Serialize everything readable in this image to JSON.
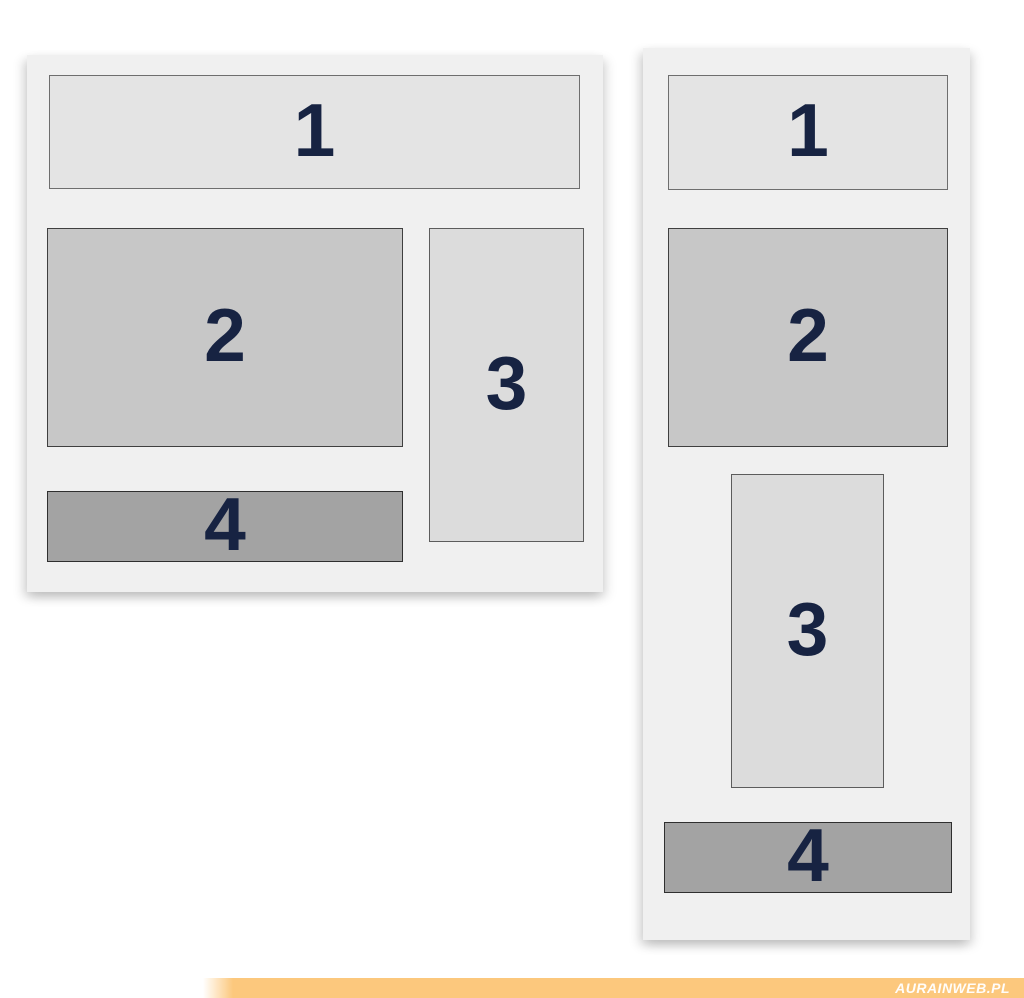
{
  "diagram": {
    "desktop": {
      "blocks": [
        {
          "label": "1"
        },
        {
          "label": "2"
        },
        {
          "label": "3"
        },
        {
          "label": "4"
        }
      ]
    },
    "mobile": {
      "blocks": [
        {
          "label": "1"
        },
        {
          "label": "2"
        },
        {
          "label": "3"
        },
        {
          "label": "4"
        }
      ]
    }
  },
  "watermark": {
    "text": "AURAINWEB.PL"
  },
  "colors": {
    "page_background": "#ffffff",
    "panel_background": "#f0f0f0",
    "block1_fill": "#e4e4e4",
    "block2_fill": "#c7c7c7",
    "block3_fill": "#dcdcdc",
    "block4_fill": "#a3a3a3",
    "block_border_light": "#6e6e6e",
    "block_border_dark": "#2f2f2f",
    "number_color": "#172342",
    "watermark_bar": "#fcc87d",
    "watermark_text": "#ffffff"
  }
}
